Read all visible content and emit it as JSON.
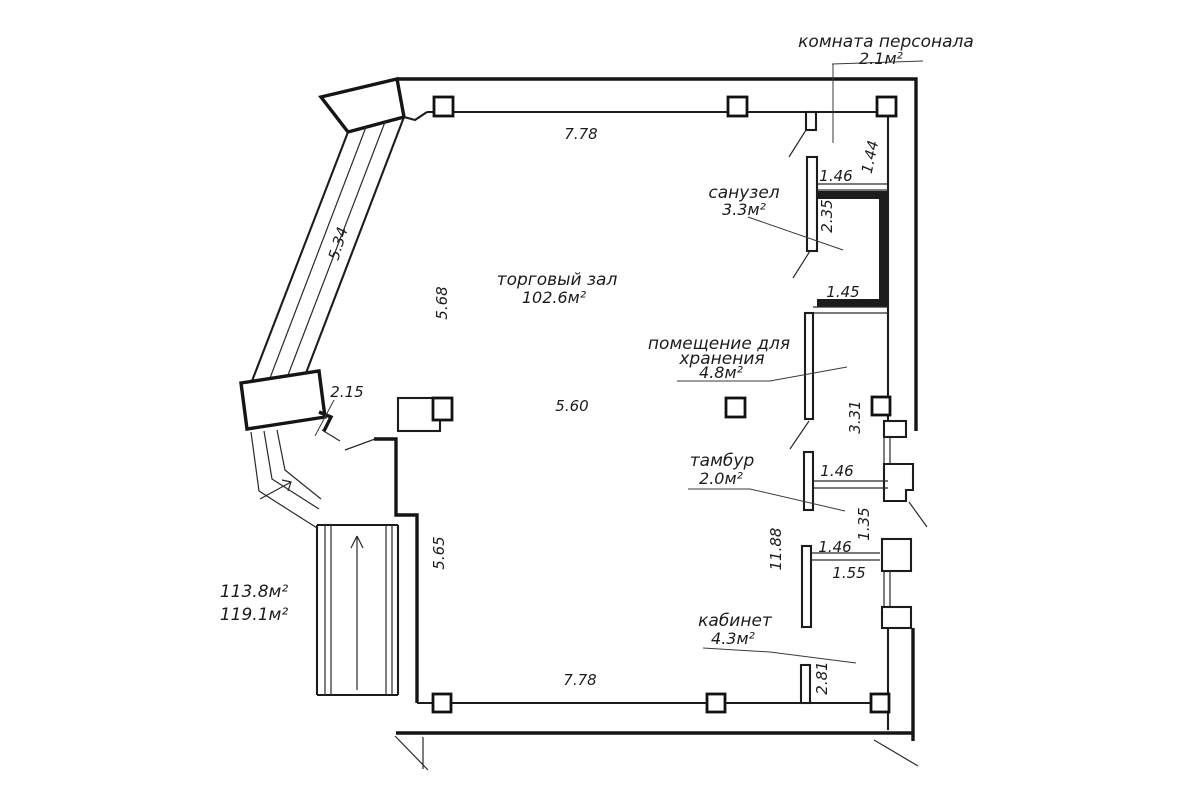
{
  "rooms": {
    "staff": {
      "name": "комната персонала",
      "area": "2.1м²"
    },
    "bathroom": {
      "name": "санузел",
      "area": "3.3м²"
    },
    "hall": {
      "name": "торговый зал",
      "area": "102.6м²"
    },
    "storage": {
      "name_line1": "помещение для",
      "name_line2": "хранения",
      "area": "4.8м²"
    },
    "vestibule": {
      "name": "тамбур",
      "area": "2.0м²"
    },
    "office": {
      "name": "кабинет",
      "area": "4.3м²"
    }
  },
  "totals": {
    "area_1": "113.8м²",
    "area_2": "119.1м²"
  },
  "dims": {
    "top_width": "7.78",
    "bottom_width": "7.78",
    "diagonal_wall": "5.34",
    "left_upper": "5.68",
    "left_lower": "5.65",
    "hall_center": "5.60",
    "porch": "2.15",
    "staff_width": "1.46",
    "staff_height": "1.44",
    "bath_height": "2.35",
    "bath_width": "1.45",
    "storage_height": "3.31",
    "vest_width_top": "1.46",
    "vest_gap": "1.35",
    "right_side_height": "11.88",
    "vest_width_bottom": "1.46",
    "office_width": "1.55",
    "office_height": "2.81"
  },
  "line_color": "#1c1c1c",
  "background": "#ffffff"
}
